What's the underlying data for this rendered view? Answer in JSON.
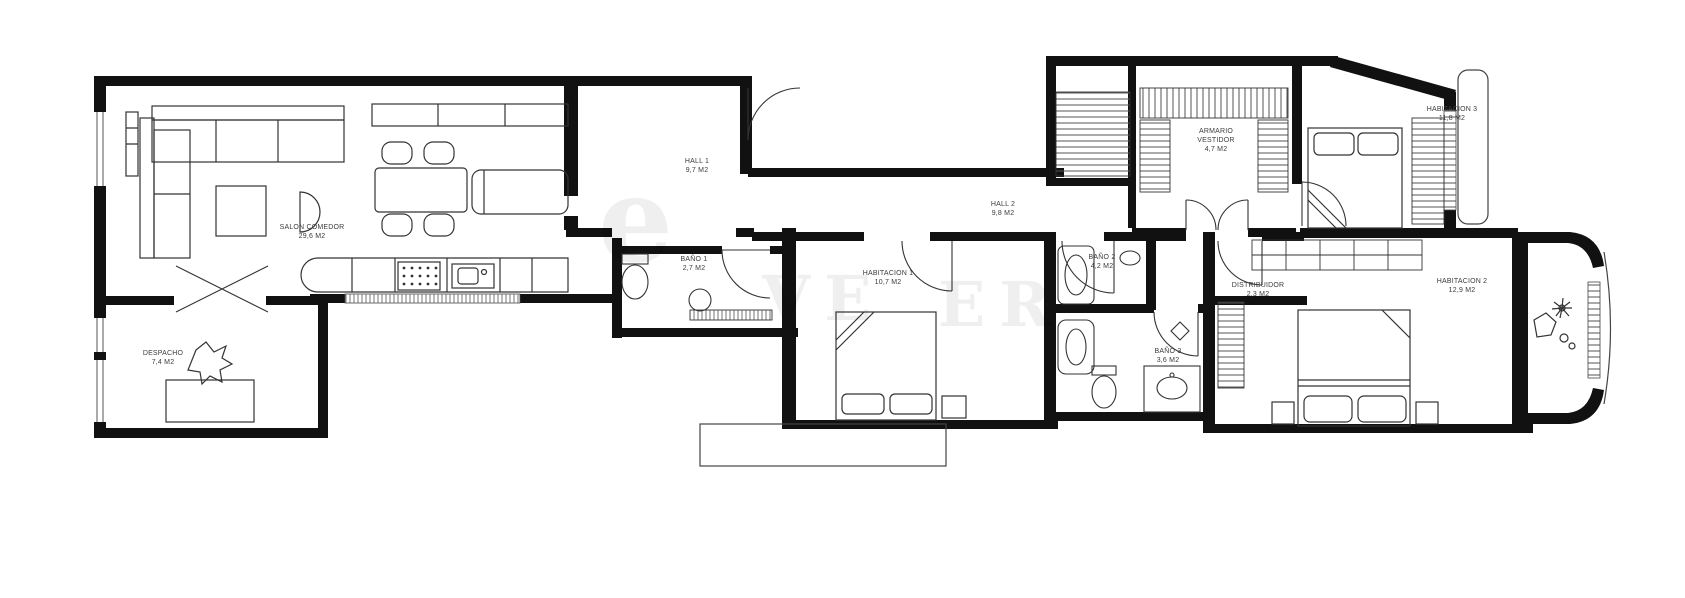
{
  "plan": {
    "type": "apartment floor plan",
    "wall_color": "#111111",
    "furniture_line_color": "#333333",
    "label_color": "#3c3c3c"
  },
  "rooms": [
    {
      "id": "salon-comedor",
      "name": "SALON COMEDOR",
      "area": "29,6 M2"
    },
    {
      "id": "despacho",
      "name": "DESPACHO",
      "area": "7,4 M2"
    },
    {
      "id": "hall-1",
      "name": "HALL 1",
      "area": "9,7 M2"
    },
    {
      "id": "bano-1",
      "name": "BAÑO 1",
      "area": "2,7 M2"
    },
    {
      "id": "hall-2",
      "name": "HALL 2",
      "area": "9,8 M2"
    },
    {
      "id": "habitacion-1",
      "name": "HABITACION 1",
      "area": "10,7 M2"
    },
    {
      "id": "bano-2",
      "name": "BAÑO 2",
      "area": "4,2 M2"
    },
    {
      "id": "armario-vestidor",
      "name": "ARMARIO VESTIDOR",
      "area": "4,7 M2"
    },
    {
      "id": "habitacion-3",
      "name": "HABITACION 3",
      "area": "11,8 M2"
    },
    {
      "id": "distribuidor",
      "name": "DISTRIBUIDOR",
      "area": "2,3 M2"
    },
    {
      "id": "bano-3",
      "name": "BAÑO 3",
      "area": "3,6 M2"
    },
    {
      "id": "habitacion-2",
      "name": "HABITACION 2",
      "area": "12,9 M2"
    }
  ],
  "watermark": {
    "fragments": [
      {
        "text": "e"
      },
      {
        "text": "VE"
      },
      {
        "text": "ER"
      }
    ]
  }
}
